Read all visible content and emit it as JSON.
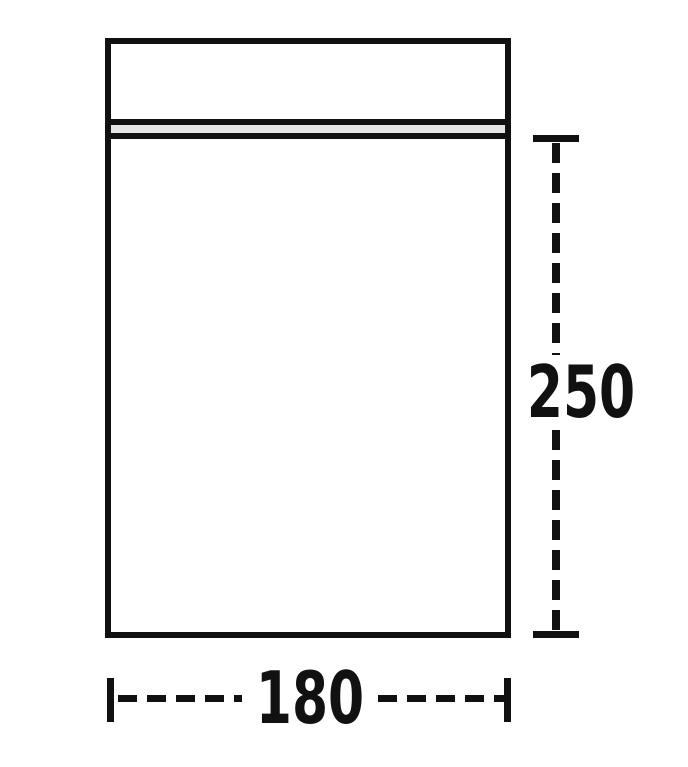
{
  "diagram": {
    "description": "Dimensioned outline drawing of a zip-seal bag",
    "dimensions": {
      "height": {
        "label": "250"
      },
      "width": {
        "label": "180"
      }
    }
  },
  "colors": {
    "line": "#111111",
    "seal_fill": "#e5e5e5",
    "background": "#ffffff"
  }
}
